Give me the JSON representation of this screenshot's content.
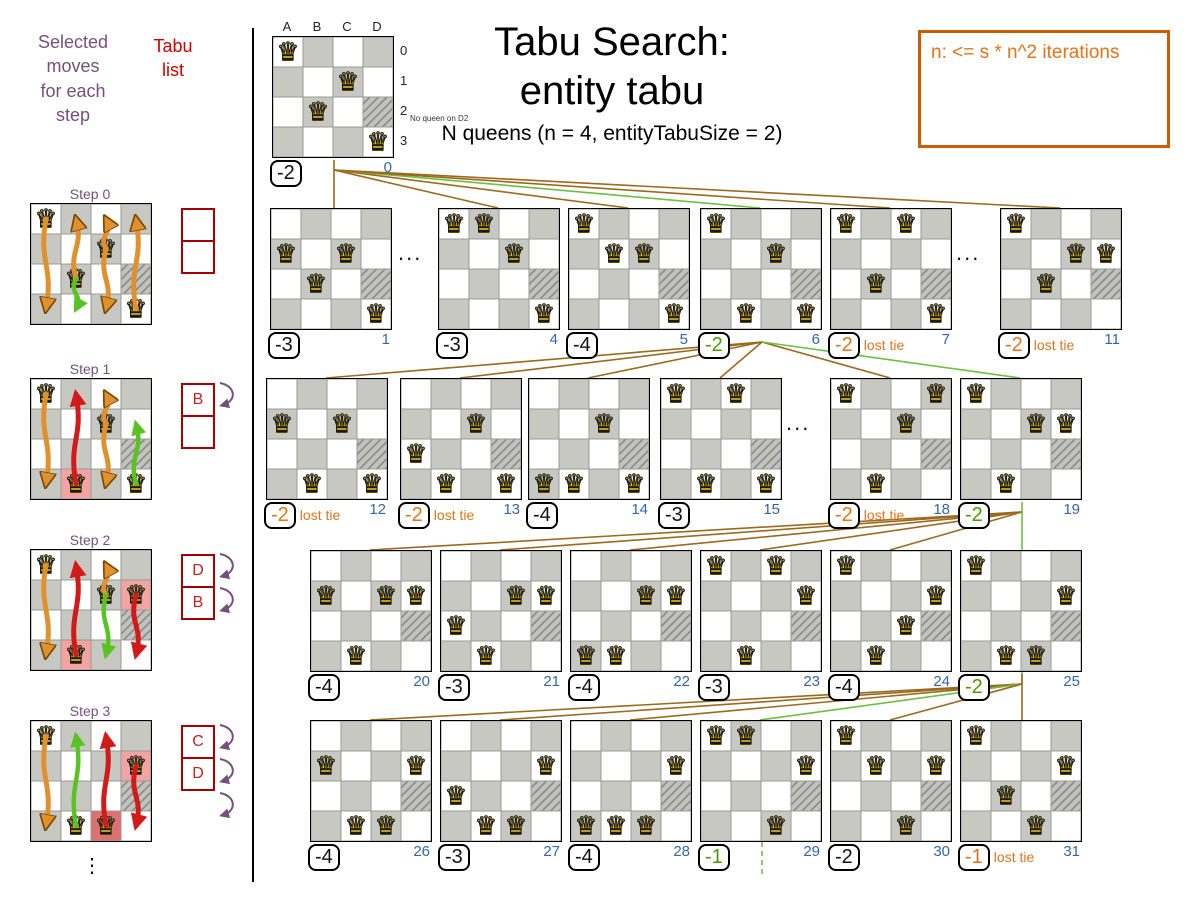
{
  "header": {
    "title_line1": "Tabu Search:",
    "title_line2": "entity tabu",
    "subtitle": "N queens (n = 4, entityTabuSize = 2)"
  },
  "note_box": {
    "text": "n: <= s * n^2 iterations"
  },
  "left_panel": {
    "moves_header": "Selected\nmoves\nfor each\nstep",
    "tabu_header": "Tabu\nlist",
    "ellipsis": "⋮",
    "steps": [
      {
        "label": "Step 0",
        "y": 203,
        "queens": [
          "A0",
          "C1",
          "B2",
          "D3"
        ],
        "hatched": [
          "D2"
        ],
        "highlights": [],
        "tabu": [
          "",
          ""
        ],
        "purple_arrows": 0,
        "arrows": [
          {
            "col": "A",
            "from": 0,
            "to": 3,
            "color": "orange"
          },
          {
            "col": "B",
            "from": 2,
            "to": 0,
            "color": "orange"
          },
          {
            "col": "B",
            "from": 2,
            "to": 3,
            "color": "green"
          },
          {
            "col": "C",
            "from": 1,
            "to": 0,
            "color": "orange"
          },
          {
            "col": "C",
            "from": 1,
            "to": 3,
            "color": "orange"
          },
          {
            "col": "D",
            "from": 3,
            "to": 0,
            "color": "orange"
          }
        ]
      },
      {
        "label": "Step 1",
        "y": 378,
        "queens": [
          "A0",
          "C1",
          "B3",
          "D3"
        ],
        "hatched": [
          "D2"
        ],
        "highlights": [
          {
            "cell": "B3",
            "color": "pink"
          }
        ],
        "tabu": [
          "B",
          ""
        ],
        "purple_arrows": 1,
        "arrows": [
          {
            "col": "A",
            "from": 0,
            "to": 3,
            "color": "orange"
          },
          {
            "col": "B",
            "from": 3,
            "to": 0,
            "color": "red"
          },
          {
            "col": "C",
            "from": 1,
            "to": 0,
            "color": "orange"
          },
          {
            "col": "C",
            "from": 1,
            "to": 3,
            "color": "orange"
          },
          {
            "col": "D",
            "from": 3,
            "to": 1,
            "color": "green"
          }
        ]
      },
      {
        "label": "Step 2",
        "y": 549,
        "queens": [
          "A0",
          "C1",
          "D1",
          "B3"
        ],
        "hatched": [
          "D2"
        ],
        "highlights": [
          {
            "cell": "D1",
            "color": "pink"
          },
          {
            "cell": "B3",
            "color": "pink"
          }
        ],
        "tabu": [
          "D",
          "B"
        ],
        "purple_arrows": 2,
        "arrows": [
          {
            "col": "A",
            "from": 0,
            "to": 3,
            "color": "orange"
          },
          {
            "col": "B",
            "from": 3,
            "to": 0,
            "color": "red"
          },
          {
            "col": "C",
            "from": 1,
            "to": 0,
            "color": "orange"
          },
          {
            "col": "C",
            "from": 1,
            "to": 3,
            "color": "green"
          },
          {
            "col": "D",
            "from": 1,
            "to": 3,
            "color": "red"
          }
        ]
      },
      {
        "label": "Step 3",
        "y": 720,
        "queens": [
          "A0",
          "D1",
          "B3",
          "C3"
        ],
        "hatched": [
          "D2"
        ],
        "highlights": [
          {
            "cell": "D1",
            "color": "pink"
          },
          {
            "cell": "C3",
            "color": "red"
          }
        ],
        "tabu": [
          "C",
          "D"
        ],
        "purple_arrows": 3,
        "arrows": [
          {
            "col": "A",
            "from": 0,
            "to": 3,
            "color": "orange"
          },
          {
            "col": "B",
            "from": 3,
            "to": 0,
            "color": "green"
          },
          {
            "col": "C",
            "from": 3,
            "to": 0,
            "color": "red"
          },
          {
            "col": "D",
            "from": 1,
            "to": 3,
            "color": "red"
          }
        ]
      }
    ]
  },
  "root_labels": {
    "col_labels": [
      "A",
      "B",
      "C",
      "D"
    ],
    "row_labels": [
      "0",
      "1",
      "2",
      "3"
    ],
    "annotation": "No queen on D2"
  },
  "tree": {
    "boards": [
      {
        "id": 0,
        "x": 272,
        "y": 36,
        "score": "-2",
        "color": "black",
        "lost_tie": false,
        "index": "0",
        "queens": [
          "A0",
          "C1",
          "B2",
          "D3"
        ],
        "hatched": [
          "D2"
        ]
      },
      {
        "id": 1,
        "x": 270,
        "y": 208,
        "score": "-3",
        "color": "black",
        "lost_tie": false,
        "index": "1",
        "queens": [
          "A1",
          "C1",
          "B2",
          "D3"
        ],
        "hatched": [
          "D2"
        ]
      },
      {
        "id": 4,
        "x": 438,
        "y": 208,
        "score": "-3",
        "color": "black",
        "lost_tie": false,
        "index": "4",
        "queens": [
          "A0",
          "B0",
          "C1",
          "D3"
        ],
        "hatched": [
          "D2"
        ]
      },
      {
        "id": 5,
        "x": 568,
        "y": 208,
        "score": "-4",
        "color": "black",
        "lost_tie": false,
        "index": "5",
        "queens": [
          "A0",
          "B1",
          "C1",
          "D3"
        ],
        "hatched": [
          "D2"
        ]
      },
      {
        "id": 6,
        "x": 700,
        "y": 208,
        "score": "-2",
        "color": "green",
        "lost_tie": false,
        "index": "6",
        "queens": [
          "A0",
          "C1",
          "B3",
          "D3"
        ],
        "hatched": [
          "D2"
        ]
      },
      {
        "id": 7,
        "x": 830,
        "y": 208,
        "score": "-2",
        "color": "orange",
        "lost_tie": true,
        "index": "7",
        "queens": [
          "A0",
          "C0",
          "B2",
          "D3"
        ],
        "hatched": [
          "D2"
        ]
      },
      {
        "id": 11,
        "x": 1000,
        "y": 208,
        "score": "-2",
        "color": "orange",
        "lost_tie": true,
        "index": "11",
        "queens": [
          "A0",
          "C1",
          "D1",
          "B2"
        ],
        "hatched": [
          "D2"
        ]
      },
      {
        "id": 12,
        "x": 266,
        "y": 378,
        "score": "-2",
        "color": "orange",
        "lost_tie": true,
        "index": "12",
        "queens": [
          "A1",
          "C1",
          "B3",
          "D3"
        ],
        "hatched": [
          "D2"
        ]
      },
      {
        "id": 13,
        "x": 400,
        "y": 378,
        "score": "-2",
        "color": "orange",
        "lost_tie": true,
        "index": "13",
        "queens": [
          "C1",
          "A2",
          "B3",
          "D3"
        ],
        "hatched": [
          "D2"
        ]
      },
      {
        "id": 14,
        "x": 528,
        "y": 378,
        "score": "-4",
        "color": "black",
        "lost_tie": false,
        "index": "14",
        "queens": [
          "C1",
          "A3",
          "B3",
          "D3"
        ],
        "hatched": [
          "D2"
        ]
      },
      {
        "id": 15,
        "x": 660,
        "y": 378,
        "score": "-3",
        "color": "black",
        "lost_tie": false,
        "index": "15",
        "queens": [
          "A0",
          "C0",
          "B3",
          "D3"
        ],
        "hatched": [
          "D2"
        ]
      },
      {
        "id": 18,
        "x": 830,
        "y": 378,
        "score": "-2",
        "color": "orange",
        "lost_tie": true,
        "index": "18",
        "queens": [
          "A0",
          "D0",
          "C1",
          "B3"
        ],
        "hatched": [
          "D2"
        ]
      },
      {
        "id": 19,
        "x": 960,
        "y": 378,
        "score": "-2",
        "color": "green",
        "lost_tie": false,
        "index": "19",
        "queens": [
          "A0",
          "C1",
          "D1",
          "B3"
        ],
        "hatched": [
          "D2"
        ]
      },
      {
        "id": 20,
        "x": 310,
        "y": 550,
        "score": "-4",
        "color": "black",
        "lost_tie": false,
        "index": "20",
        "queens": [
          "A1",
          "C1",
          "D1",
          "B3"
        ],
        "hatched": [
          "D2"
        ]
      },
      {
        "id": 21,
        "x": 440,
        "y": 550,
        "score": "-3",
        "color": "black",
        "lost_tie": false,
        "index": "21",
        "queens": [
          "C1",
          "D1",
          "A2",
          "B3"
        ],
        "hatched": [
          "D2"
        ]
      },
      {
        "id": 22,
        "x": 570,
        "y": 550,
        "score": "-4",
        "color": "black",
        "lost_tie": false,
        "index": "22",
        "queens": [
          "C1",
          "D1",
          "A3",
          "B3"
        ],
        "hatched": [
          "D2"
        ]
      },
      {
        "id": 23,
        "x": 700,
        "y": 550,
        "score": "-3",
        "color": "black",
        "lost_tie": false,
        "index": "23",
        "queens": [
          "A0",
          "C0",
          "D1",
          "B3"
        ],
        "hatched": [
          "D2"
        ]
      },
      {
        "id": 24,
        "x": 830,
        "y": 550,
        "score": "-4",
        "color": "black",
        "lost_tie": false,
        "index": "24",
        "queens": [
          "A0",
          "D1",
          "C2",
          "B3"
        ],
        "hatched": [
          "D2"
        ]
      },
      {
        "id": 25,
        "x": 960,
        "y": 550,
        "score": "-2",
        "color": "green",
        "lost_tie": false,
        "index": "25",
        "queens": [
          "A0",
          "D1",
          "B3",
          "C3"
        ],
        "hatched": [
          "D2"
        ]
      },
      {
        "id": 26,
        "x": 310,
        "y": 720,
        "score": "-4",
        "color": "black",
        "lost_tie": false,
        "index": "26",
        "queens": [
          "A1",
          "D1",
          "B3",
          "C3"
        ],
        "hatched": [
          "D2"
        ]
      },
      {
        "id": 27,
        "x": 440,
        "y": 720,
        "score": "-3",
        "color": "black",
        "lost_tie": false,
        "index": "27",
        "queens": [
          "D1",
          "A2",
          "B3",
          "C3"
        ],
        "hatched": [
          "D2"
        ]
      },
      {
        "id": 28,
        "x": 570,
        "y": 720,
        "score": "-4",
        "color": "black",
        "lost_tie": false,
        "index": "28",
        "queens": [
          "D1",
          "A3",
          "B3",
          "C3"
        ],
        "hatched": [
          "D2"
        ]
      },
      {
        "id": 29,
        "x": 700,
        "y": 720,
        "score": "-1",
        "color": "green",
        "lost_tie": false,
        "index": "29",
        "queens": [
          "A0",
          "B0",
          "D1",
          "C3"
        ],
        "hatched": [
          "D2"
        ]
      },
      {
        "id": 30,
        "x": 830,
        "y": 720,
        "score": "-2",
        "color": "black",
        "lost_tie": false,
        "index": "30",
        "queens": [
          "A0",
          "B1",
          "D1",
          "C3"
        ],
        "hatched": [
          "D2"
        ]
      },
      {
        "id": 31,
        "x": 960,
        "y": 720,
        "score": "-1",
        "color": "orange",
        "lost_tie": true,
        "index": "31",
        "queens": [
          "A0",
          "D1",
          "B2",
          "C3"
        ],
        "hatched": [
          "D2"
        ]
      }
    ],
    "edges": [
      {
        "from": 0,
        "to": 1,
        "mode": "drop",
        "color": "brown"
      },
      {
        "from": 0,
        "to": 4,
        "mode": "fan",
        "color": "brown"
      },
      {
        "from": 0,
        "to": 5,
        "mode": "fan",
        "color": "brown"
      },
      {
        "from": 0,
        "to": 6,
        "mode": "fan",
        "color": "green"
      },
      {
        "from": 0,
        "to": 7,
        "mode": "fan",
        "color": "brown"
      },
      {
        "from": 0,
        "to": 11,
        "mode": "fan",
        "color": "brown"
      },
      {
        "from": 6,
        "to": 12,
        "mode": "fan",
        "color": "brown"
      },
      {
        "from": 6,
        "to": 13,
        "mode": "fan",
        "color": "brown"
      },
      {
        "from": 6,
        "to": 14,
        "mode": "fan",
        "color": "brown"
      },
      {
        "from": 6,
        "to": 15,
        "mode": "fan",
        "color": "brown"
      },
      {
        "from": 6,
        "to": 18,
        "mode": "fan",
        "color": "brown"
      },
      {
        "from": 6,
        "to": 19,
        "mode": "fan",
        "color": "green"
      },
      {
        "from": 19,
        "to": 20,
        "mode": "fan",
        "color": "brown"
      },
      {
        "from": 19,
        "to": 21,
        "mode": "fan",
        "color": "brown"
      },
      {
        "from": 19,
        "to": 22,
        "mode": "fan",
        "color": "brown"
      },
      {
        "from": 19,
        "to": 23,
        "mode": "fan",
        "color": "brown"
      },
      {
        "from": 19,
        "to": 24,
        "mode": "fan",
        "color": "brown"
      },
      {
        "from": 19,
        "to": 25,
        "mode": "droplong",
        "color": "green"
      },
      {
        "from": 25,
        "to": 26,
        "mode": "fan",
        "color": "brown"
      },
      {
        "from": 25,
        "to": 27,
        "mode": "fan",
        "color": "brown"
      },
      {
        "from": 25,
        "to": 28,
        "mode": "fan",
        "color": "brown"
      },
      {
        "from": 25,
        "to": 29,
        "mode": "fan",
        "color": "green"
      },
      {
        "from": 25,
        "to": 30,
        "mode": "fan",
        "color": "brown"
      },
      {
        "from": 25,
        "to": 31,
        "mode": "drop",
        "color": "brown"
      },
      {
        "from": 29,
        "to": -1,
        "mode": "cont",
        "color": "green"
      }
    ],
    "ellipses": [
      {
        "x": 398,
        "y": 240,
        "text": "..."
      },
      {
        "x": 956,
        "y": 240,
        "text": "..."
      },
      {
        "x": 786,
        "y": 410,
        "text": "..."
      }
    ]
  },
  "colors": {
    "edge_brown": "#9c6a1e",
    "edge_green": "#6cbf3f",
    "score_green": "#4e9a06",
    "score_orange": "#e0741c",
    "index_blue": "#3465a4",
    "purple": "#75507b",
    "tabu_red": "#a40000",
    "note_orange": "#ce5c00",
    "cell_dark": "#c8c8c3",
    "highlight_pink": "#f4a3a3",
    "highlight_red": "#dd7070",
    "arrow_orange": "#e0912f",
    "arrow_red": "#d11a1a",
    "arrow_green": "#58c322"
  }
}
